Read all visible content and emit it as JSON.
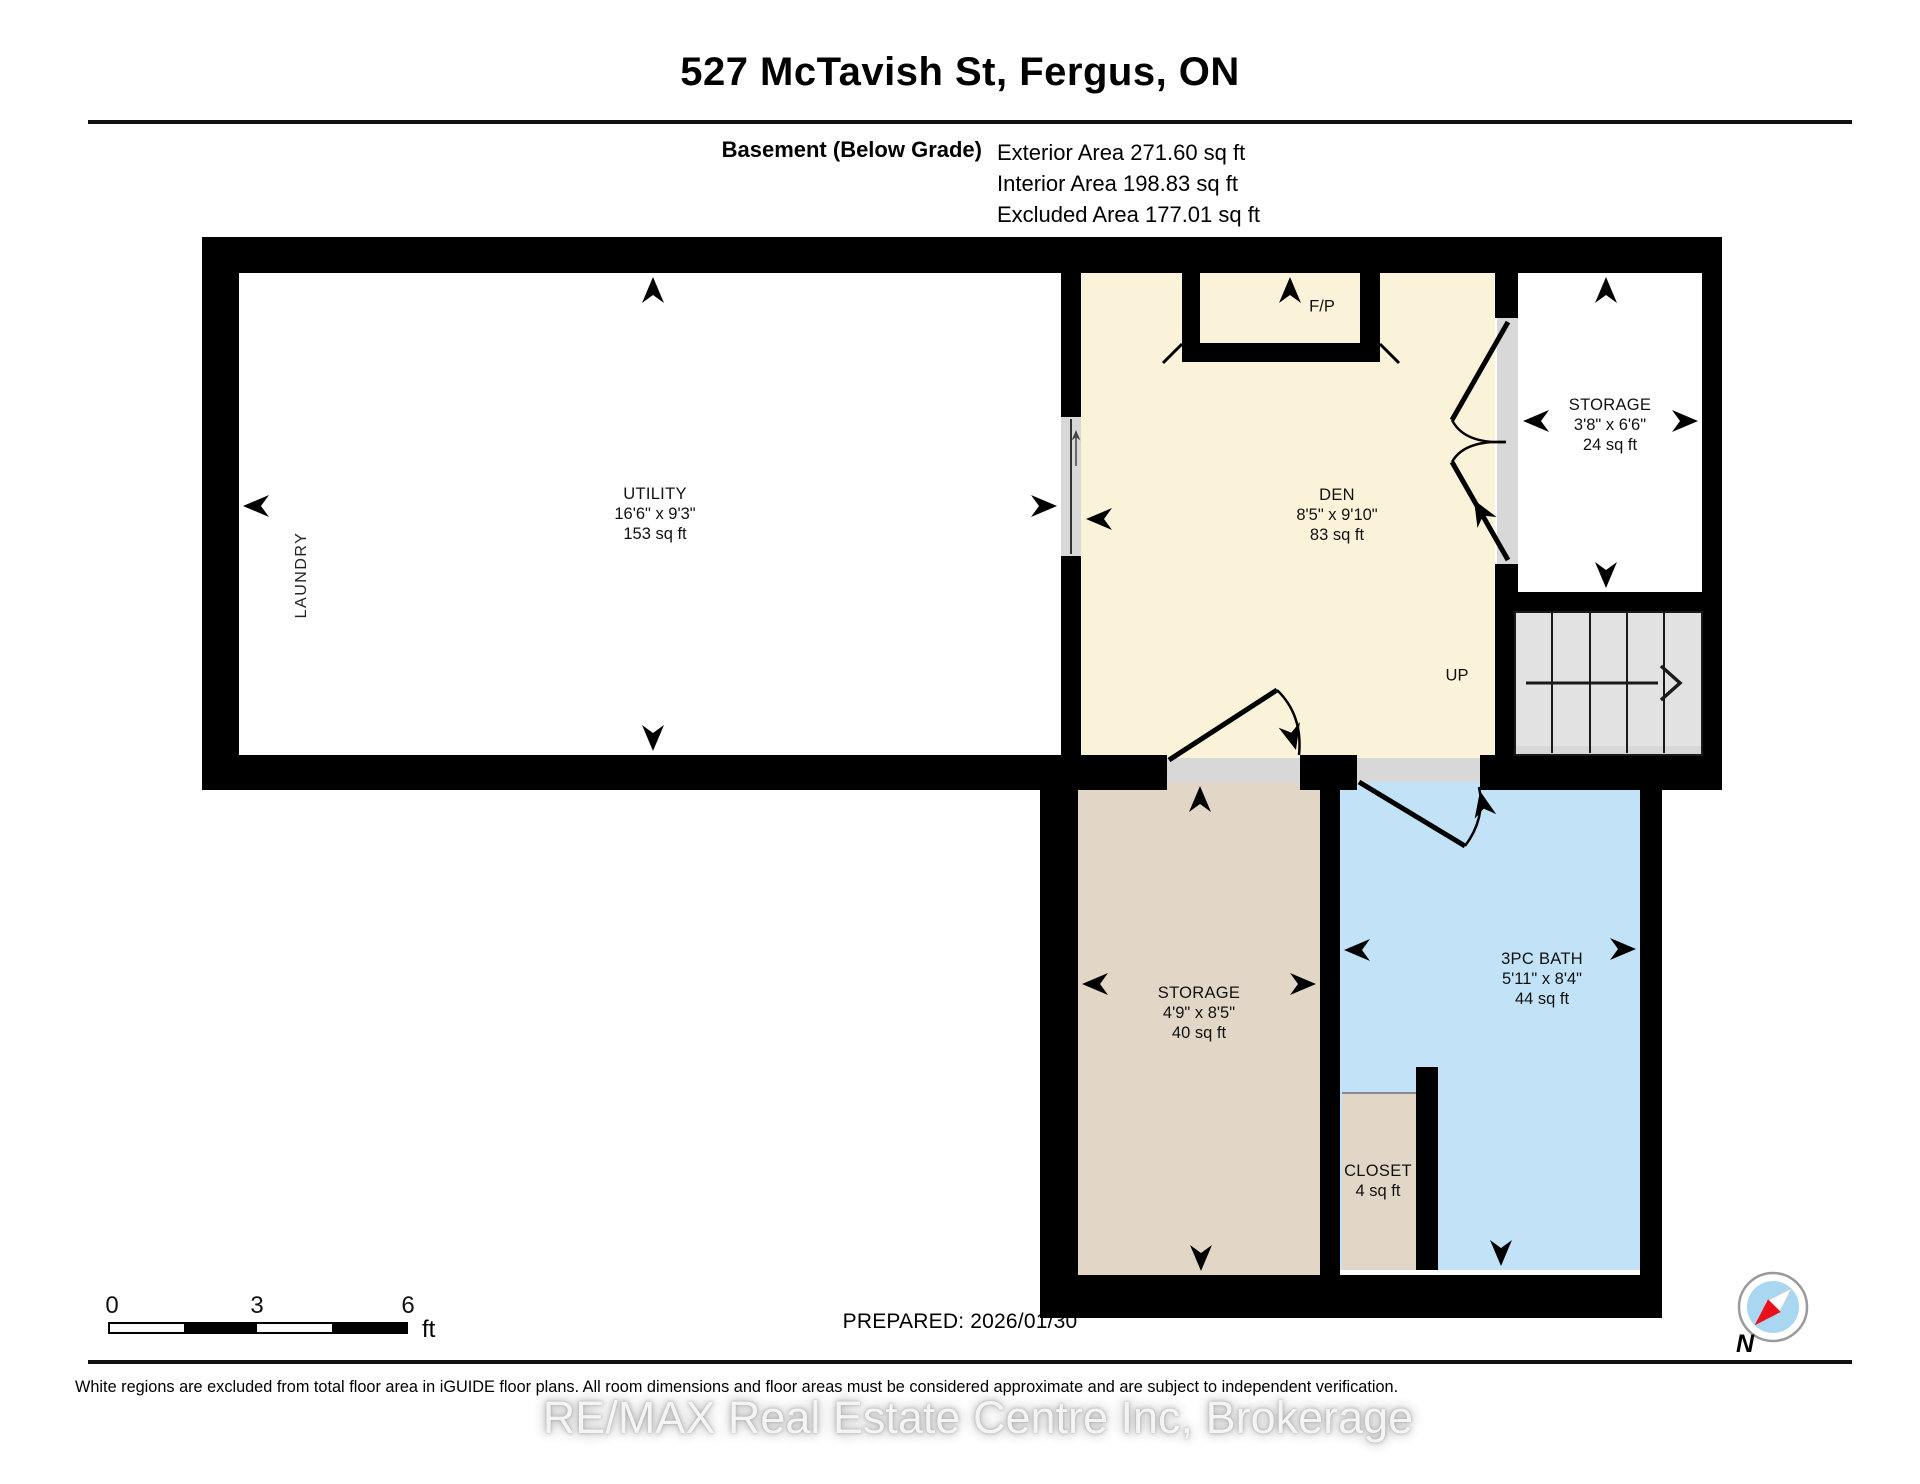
{
  "header": {
    "title": "527 McTavish St, Fergus, ON"
  },
  "subtitle": {
    "floor_label": "Basement (Below Grade)",
    "areas": [
      "Exterior Area 271.60 sq ft",
      "Interior Area 198.83 sq ft",
      "Excluded Area 177.01 sq ft"
    ]
  },
  "rooms": [
    {
      "id": "utility",
      "name": "UTILITY",
      "dims": "16'6\" x 9'3\"",
      "area": "153 sq ft"
    },
    {
      "id": "den",
      "name": "DEN",
      "dims": "8'5\" x 9'10\"",
      "area": "83 sq ft"
    },
    {
      "id": "storage-upper",
      "name": "STORAGE",
      "dims": "3'8\" x 6'6\"",
      "area": "24 sq ft"
    },
    {
      "id": "storage-lower",
      "name": "STORAGE",
      "dims": "4'9\" x 8'5\"",
      "area": "40 sq ft"
    },
    {
      "id": "bath",
      "name": "3PC BATH",
      "dims": "5'11\" x 8'4\"",
      "area": "44 sq ft"
    },
    {
      "id": "closet",
      "name": "CLOSET",
      "dims": "",
      "area": "4 sq ft"
    }
  ],
  "annotations": {
    "laundry": "LAUNDRY",
    "fireplace": "F/P",
    "stairs_up": "UP",
    "north": "N"
  },
  "scale_bar": {
    "ticks": [
      "0",
      "3",
      "6"
    ],
    "unit": "ft"
  },
  "prepared": {
    "label": "PREPARED: 2026/01/30"
  },
  "footer": {
    "disclaimer": "White regions are excluded from total floor area in iGUIDE floor plans. All room dimensions and floor areas must be considered approximate and are subject to independent verification.",
    "watermark": "RE/MAX Real Estate Centre Inc, Brokerage"
  },
  "colors": {
    "wall": "#000000",
    "den_floor": "#FBF3D9",
    "storage_floor": "#E2D7C6",
    "bath_floor": "#C2E3F7",
    "stairs_floor": "#E2E2E2",
    "threshold_gray": "#D8D8D8",
    "compass_blue": "#A9D6F1",
    "compass_red": "#E8111C"
  }
}
